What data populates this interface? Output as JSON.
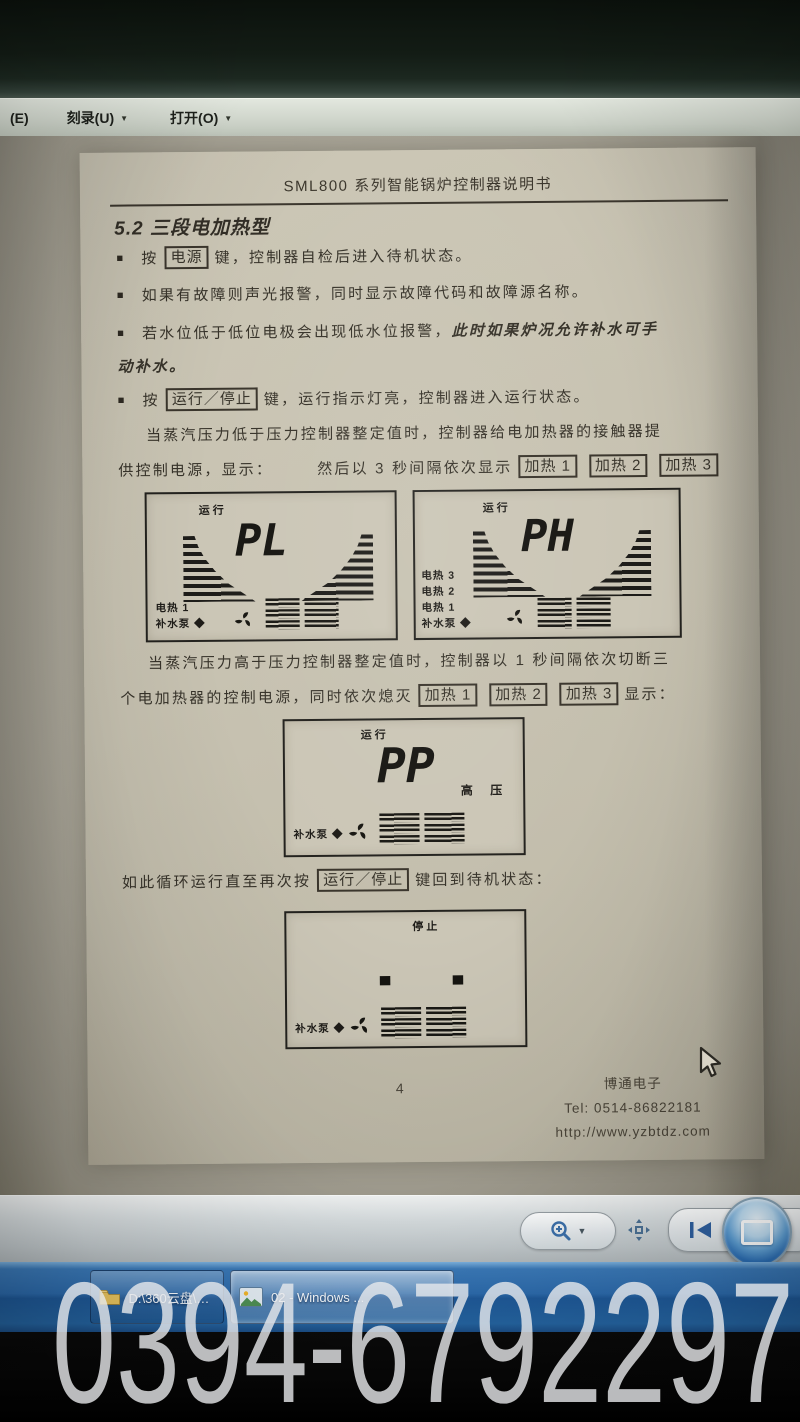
{
  "menu": {
    "e": "(E)",
    "burn": "刻录(U)",
    "open": "打开(O)"
  },
  "icons": {
    "caret": "▼"
  },
  "doc": {
    "header_title": "SML800 系列智能锅炉控制器说明书",
    "section_title": "5.2 三段电加热型",
    "marker": "■",
    "b1": {
      "pre": "按",
      "key": "电源",
      "post": "键，控制器自检后进入待机状态。"
    },
    "b2": {
      "text": "如果有故障则声光报警，同时显示故障代码和故障源名称。"
    },
    "b3": {
      "normal": "若水位低于低位电极会出现低水位报警，",
      "italic1": "此时如果炉况允许补水可手",
      "italic2": "动补水。"
    },
    "b4": {
      "pre": "按",
      "key": "运行／停止",
      "post": "键，运行指示灯亮，控制器进入运行状态。"
    },
    "p1": {
      "line1": "当蒸汽压力低于压力控制器整定值时，控制器给电加热器的接触器提",
      "line2a": "供控制电源，显示：",
      "line2b": "然后以 3 秒间隔依次显示",
      "k1": "加热 1",
      "k2": "加热 2",
      "k3": "加热 3"
    },
    "p2": {
      "line1": "当蒸汽压力高于压力控制器整定值时，控制器以 1 秒间隔依次切断三",
      "line2a": "个电加热器的控制电源，同时依次熄灭",
      "k1": "加热 1",
      "k2": "加热 2",
      "k3": "加热 3",
      "line2b": "显示："
    },
    "loop": {
      "pre": "如此循环运行直至再次按",
      "key": "运行／停止",
      "post": "键回到待机状态："
    },
    "lcd_pl": {
      "status": "运行",
      "value": "PL",
      "l1": "电热 1",
      "l2": "补水泵 ◆"
    },
    "lcd_ph": {
      "status": "运行",
      "value": "PH",
      "l1": "电热 3",
      "l2": "电热 2",
      "l3": "电热 1",
      "l4": "补水泵 ◆"
    },
    "lcd_pp": {
      "status": "运行",
      "value": "PP",
      "right": "高 压",
      "l1": "补水泵 ◆"
    },
    "lcd_stop": {
      "status": "停止",
      "value": "- -",
      "l1": "补水泵 ◆"
    },
    "footer": {
      "page": "4",
      "company": "博通电子",
      "tel": "Tel: 0514-86822181",
      "url": "http://www.yzbtdz.com"
    }
  },
  "taskbar": {
    "btn1": "D:\\360云盘\\仪表...",
    "btn2": "02 - Windows ..."
  },
  "watermark": "0394-6792297"
}
